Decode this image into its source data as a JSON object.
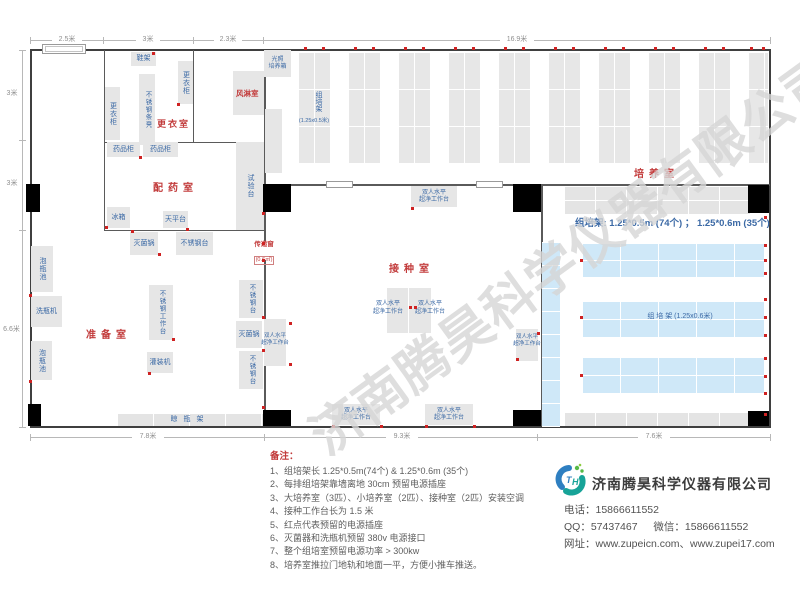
{
  "plan": {
    "rooms": {
      "changing": "更衣室",
      "air_shower": "风淋室",
      "dispensing": "配药室",
      "prep": "准备室",
      "inoculation": "接种室",
      "culture": "培养室"
    },
    "equipment": {
      "shoe_rack": "鞋架",
      "wardrobe": "更衣柜",
      "steel_bench": "不锈钢条凳",
      "medicine_cabinet": "药品柜",
      "fridge": "冰箱",
      "balance_table": "天平台",
      "test_bench": "试验台",
      "sterilizer": "灭菌锅",
      "ss_table": "不锈钢台",
      "ss_worktable": "不锈钢工作台",
      "filling_machine": "灌装机",
      "bottle_pool": "泡瓶池",
      "bottle_washer": "洗瓶机",
      "drying_rack": "晾瓶架",
      "clean_bench_l1": "双人水平",
      "clean_bench_l2": "超净工作台",
      "incubator_l1": "光照",
      "incubator_l2": "培养箱",
      "pass_window": "传递窗",
      "pass_window_size": "(0.6㎡)"
    },
    "racks": {
      "col_label": "组培架",
      "col_size": "(1.25x0.5米)",
      "right_label": "组  培  架 (1.25x0.6米)",
      "summary": "组培架: 1.25*0.5m (74个) ； 1.25*0.6m (35个)"
    },
    "dimensions": {
      "top": [
        "2.5米",
        "3米",
        "2.3米",
        "16.9米"
      ],
      "left": [
        "3米",
        "3米",
        "6.6米"
      ],
      "bottom": [
        "7.8米",
        "9.3米",
        "7.6米"
      ]
    },
    "power_sockets": [
      [
        304,
        47
      ],
      [
        322,
        47
      ],
      [
        354,
        47
      ],
      [
        372,
        47
      ],
      [
        404,
        47
      ],
      [
        422,
        47
      ],
      [
        454,
        47
      ],
      [
        472,
        47
      ],
      [
        504,
        47
      ],
      [
        522,
        47
      ],
      [
        554,
        47
      ],
      [
        572,
        47
      ],
      [
        604,
        47
      ],
      [
        622,
        47
      ],
      [
        654,
        47
      ],
      [
        672,
        47
      ],
      [
        704,
        47
      ],
      [
        722,
        47
      ],
      [
        750,
        47
      ],
      [
        762,
        47
      ],
      [
        764,
        216
      ],
      [
        764,
        244
      ],
      [
        764,
        259
      ],
      [
        764,
        272
      ],
      [
        764,
        298
      ],
      [
        764,
        316
      ],
      [
        764,
        334
      ],
      [
        764,
        357
      ],
      [
        764,
        375
      ],
      [
        764,
        392
      ],
      [
        764,
        413
      ],
      [
        29,
        294
      ],
      [
        29,
        380
      ],
      [
        262,
        242
      ],
      [
        262,
        259
      ],
      [
        262,
        212
      ],
      [
        262,
        406
      ],
      [
        131,
        230
      ],
      [
        158,
        253
      ],
      [
        172,
        338
      ],
      [
        148,
        372
      ],
      [
        262,
        316
      ],
      [
        262,
        349
      ],
      [
        289,
        322
      ],
      [
        289,
        363
      ],
      [
        105,
        226
      ],
      [
        139,
        156
      ],
      [
        186,
        228
      ],
      [
        152,
        52
      ],
      [
        177,
        103
      ],
      [
        409,
        306
      ],
      [
        414,
        306
      ],
      [
        411,
        207
      ],
      [
        380,
        425
      ],
      [
        425,
        425
      ],
      [
        332,
        425
      ],
      [
        473,
        425
      ],
      [
        516,
        358
      ],
      [
        537,
        332
      ],
      [
        580,
        259
      ],
      [
        580,
        316
      ],
      [
        580,
        374
      ]
    ]
  },
  "notes": {
    "title": "备注：",
    "items": [
      "1、组培架长 1.25*0.5m(74个) & 1.25*0.6m (35个)",
      "2、每排组培架靠墙离地 30cm 预留电源插座",
      "3、大培养室（3匹）、小培养室（2匹）、接种室（2匹）安装空调",
      "4、接种工作台长为 1.5 米",
      "5、红点代表预留的电源插座",
      "6、灭菌器和洗瓶机预留 380v 电源接口",
      "7、整个组培室预留电源功率 > 300kw",
      "8、培养室推拉门地轨和地面一平，方便小推车推送。"
    ]
  },
  "company": {
    "name": "济南腾昊科学仪器有限公司",
    "logo_t": "T",
    "logo_h": "H",
    "phone_label": "电话：",
    "phone": "15866611552",
    "qq_label": "QQ：",
    "qq": "57437467",
    "wechat_label": "微信：",
    "wechat": "15866611552",
    "web_label": "网址：",
    "web1": "www.zupeicn.com",
    "web_sep": "、",
    "web2": "www.zupei17.com"
  },
  "watermark": "济南腾昊科学仪器有限公司"
}
